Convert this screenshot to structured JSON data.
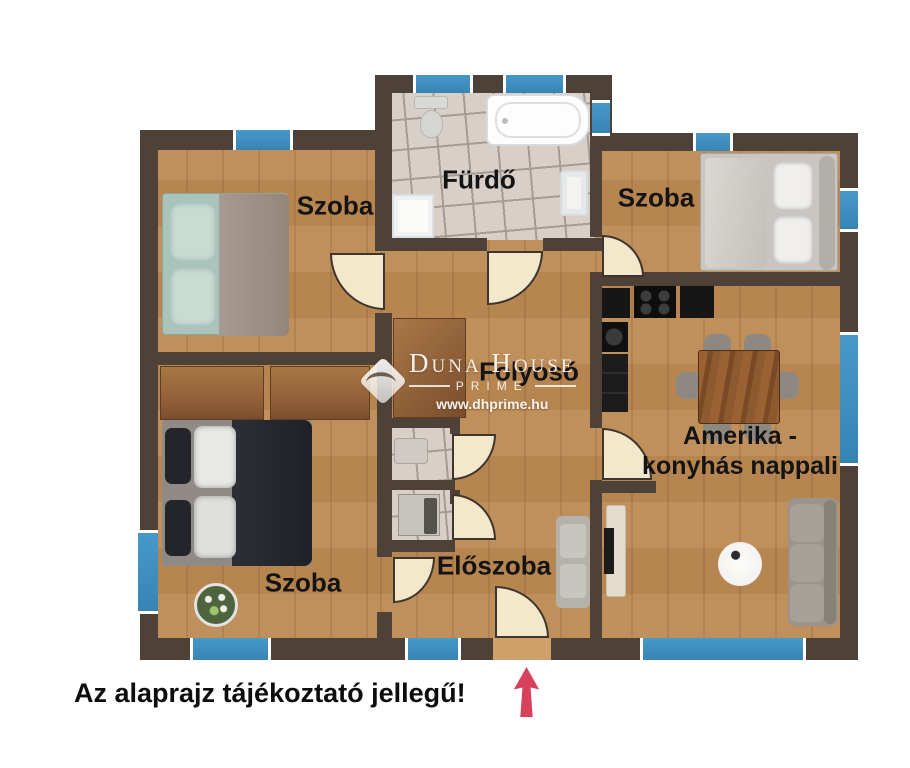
{
  "floorplan": {
    "rooms": {
      "bedroom_top_left": {
        "label": "Szoba"
      },
      "bathroom": {
        "label": "Fürdő"
      },
      "bedroom_top_right": {
        "label": "Szoba"
      },
      "hallway": {
        "label": "Folyosó"
      },
      "bedroom_bottom_left": {
        "label": "Szoba"
      },
      "entry_hall": {
        "label": "Előszoba"
      },
      "living_room": {
        "label": "Amerika - konyhás nappali"
      }
    },
    "watermark": {
      "name": "Duna House",
      "sub": "PRIME",
      "url": "www.dhprime.hu"
    },
    "caption": "Az alaprajz tájékoztató jellegű!",
    "colors": {
      "wall": "#4e4238",
      "floor_wood": "#bd8b55",
      "window_blue": "#3e90c4",
      "tile": "#d8d0c8",
      "door_leaf": "#f3e7cc",
      "entrance_arrow": "#d8415b"
    }
  }
}
